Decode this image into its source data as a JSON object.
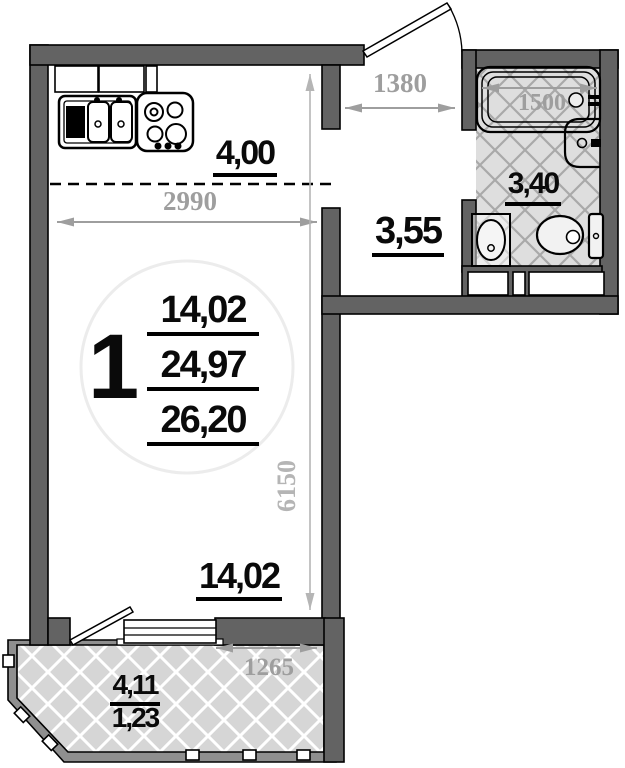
{
  "plan": {
    "unit_label": "1",
    "areas": {
      "kitchen_zone": "4,00",
      "hallway": "3,55",
      "bathroom": "3,40",
      "living_room": "14,02",
      "living_room_bottom": "14,02",
      "total_living": "24,97",
      "total_with_balcony": "26,20",
      "balcony": "4,11",
      "balcony_reduced": "1,23"
    },
    "dimensions_mm": {
      "kitchen_width": "2990",
      "hallway_width": "1380",
      "bathtub_length": "1500",
      "room_length": "6150",
      "balcony_window_width": "1265"
    },
    "fixtures": [
      "kitchen-sink-icon",
      "stove-icon",
      "bathtub-icon",
      "washbasin-icon",
      "pedestal-sink-icon",
      "toilet-icon",
      "entrance-door-icon",
      "balcony-door-icon",
      "balcony-window-icon"
    ],
    "colors": {
      "wall": "#636363",
      "hatch_bg": "#d6d6d6",
      "hatch_line": "#ffffff",
      "bath_hatch_bg": "#dedede",
      "bath_hatch_line": "#a9a9a9",
      "dim_text": "#9e9e9e",
      "dim_light": "#b5b5b5",
      "label_text": "#0a0a0a"
    }
  }
}
